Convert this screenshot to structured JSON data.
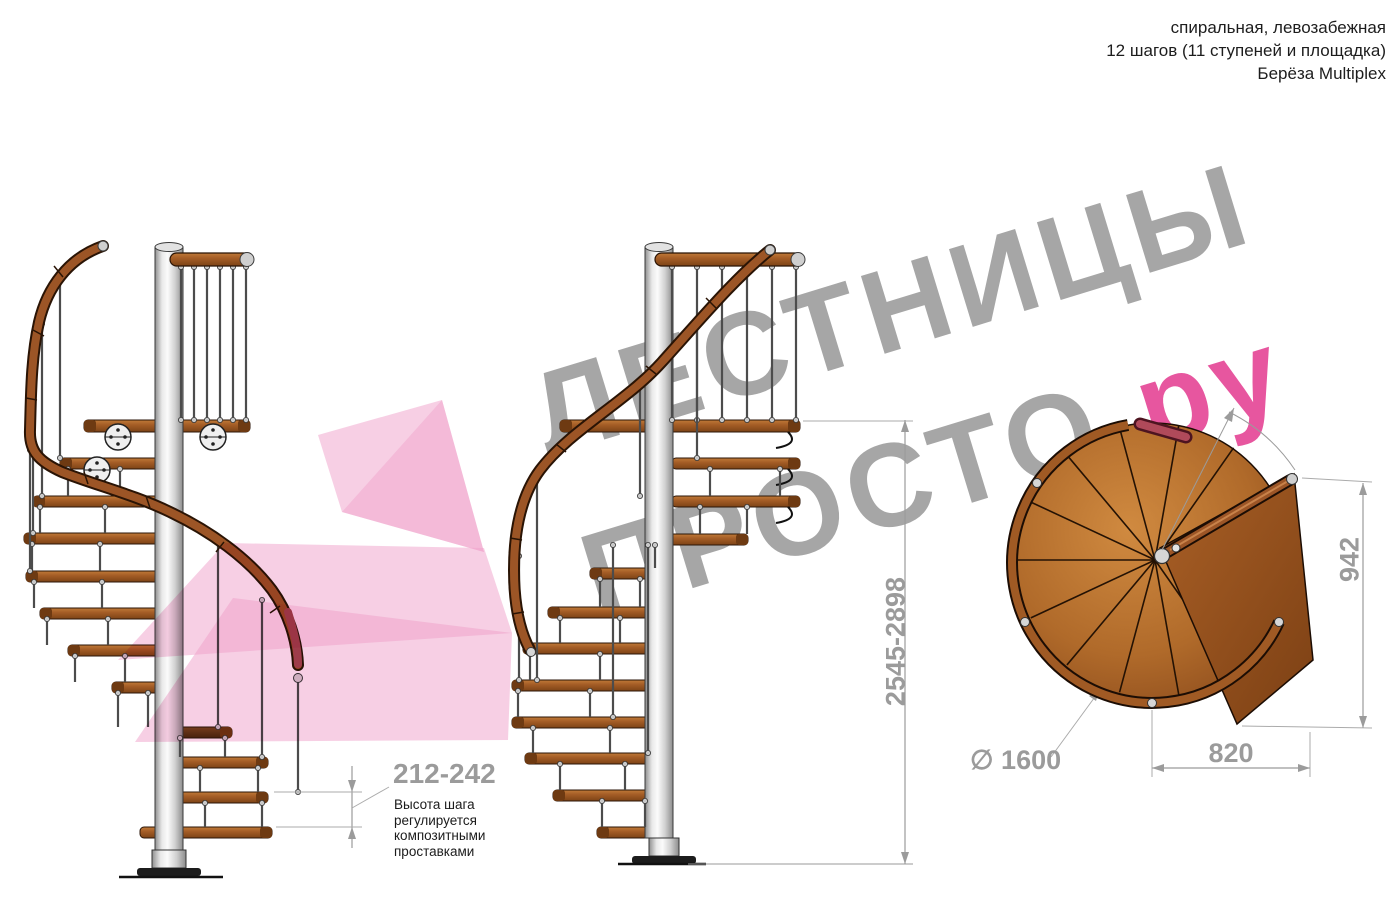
{
  "header": {
    "line1": "спиральная, левозабежная",
    "line2": "12 шагов (11 ступеней и площадка)",
    "line3": "Берёза Multiplex"
  },
  "watermark": {
    "text1": "ЛЕСТНИЦЫ",
    "text2": "ПРОСТО",
    "text2_accent": ".ру",
    "gray": "#a6a6a6",
    "pink": "#e7569f"
  },
  "dimensions": {
    "step_height": "212-242",
    "total_height": "2545-2898",
    "landing_side": "942",
    "landing_width": "820",
    "diameter_symbol": "∅",
    "diameter_value": "1600"
  },
  "annotation": {
    "l1": "Высота шага",
    "l2": "регулируется",
    "l3": "композитными",
    "l4": "проставками"
  },
  "views": {
    "left_side_view": "вид сбоку 1",
    "front_side_view": "вид сбоку 2",
    "plan_view": "вид сверху"
  },
  "colors": {
    "wood": "#a55d26",
    "wood_dark": "#5f3617",
    "metal_pole": "#d0d0d0",
    "rail": "#9c5526",
    "rail_end_cap": "#a34a52",
    "dimension_gray": "#9b9b9b",
    "watermark_gray": "#a6a6a6",
    "accent_pink": "#ef9fc9",
    "text_black": "#1d1d1d"
  }
}
